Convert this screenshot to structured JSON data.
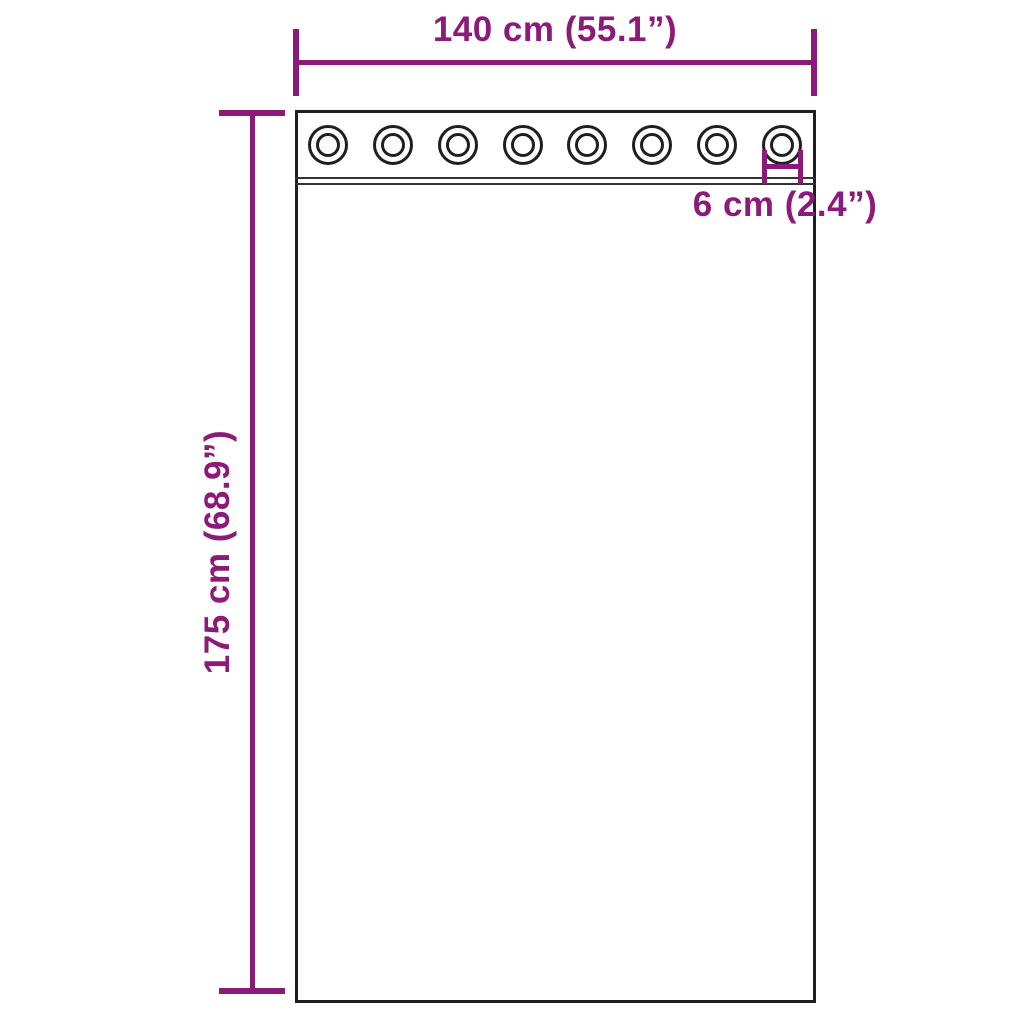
{
  "diagram": {
    "product": "curtain with grommets",
    "dimensions": {
      "width": {
        "label": "140 cm (55.1”)"
      },
      "height": {
        "label": "175 cm (68.9”)"
      },
      "grommet": {
        "label": "6 cm (2.4”)"
      }
    },
    "curtain": {
      "grommets": {
        "count": 8
      }
    },
    "colors": {
      "dimension_accent": "#8C1A7A",
      "outline": "#1f1f1f",
      "background": "#ffffff"
    }
  }
}
